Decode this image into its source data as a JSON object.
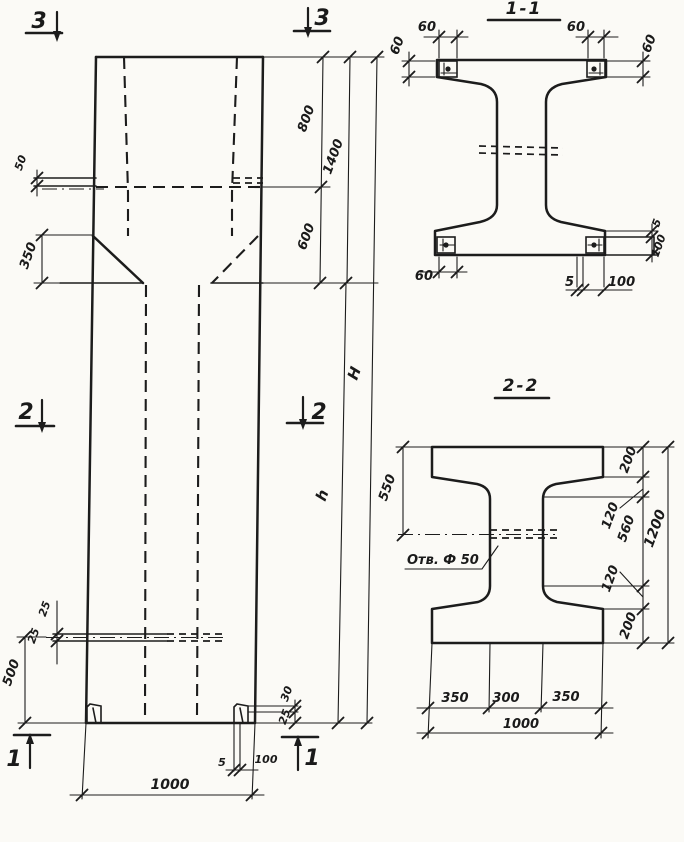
{
  "page": {
    "background": "#fbfaf6",
    "ink": "#1c1c1c"
  },
  "elevation": {
    "marks": {
      "sec3": "3",
      "sec2": "2",
      "sec1": "1"
    },
    "dims": {
      "console_step": "50",
      "taper_height": "350",
      "top_800": "800",
      "mid_600": "600",
      "head_1400": "1400",
      "total_H": "H",
      "shaft_h": "h",
      "hole_off_top": "25",
      "hole_off_bot": "25",
      "hole_to_base": "500",
      "corner_30": "30",
      "corner_25": "25",
      "angle_t_5": "5",
      "angle_leg_100": "100",
      "base_1000": "1000"
    }
  },
  "section11": {
    "title": "1-1",
    "dims": {
      "tl_w": "60",
      "tl_h": "60",
      "tr_w": "60",
      "tr_h": "60",
      "bl_w": "60",
      "br_t": "5",
      "br_leg": "100",
      "r_t": "5",
      "r_leg": "100"
    }
  },
  "section22": {
    "title": "2-2",
    "hole_label": "Отв. Ф 50",
    "dims": {
      "left_550": "550",
      "top_200": "200",
      "top_120": "120",
      "web_560": "560",
      "bot_120": "120",
      "bot_200": "200",
      "right_1200": "1200",
      "w_350a": "350",
      "w_300": "300",
      "w_350b": "350",
      "w_1000": "1000"
    }
  }
}
